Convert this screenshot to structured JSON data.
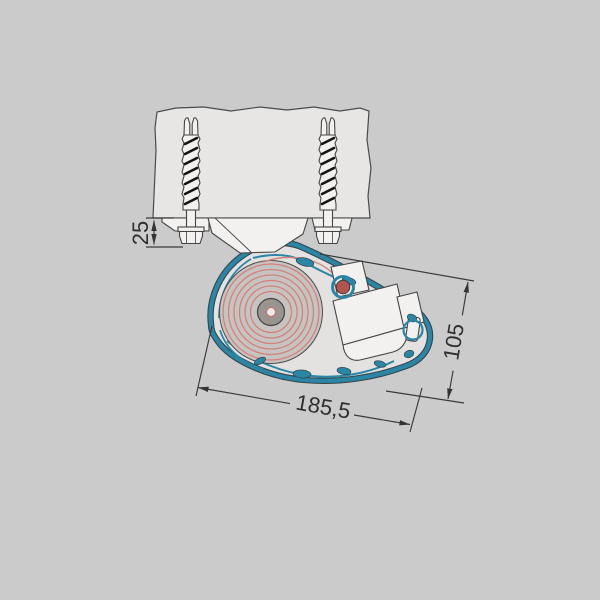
{
  "diagram": {
    "type": "technical-drawing",
    "subject": "awning-cassette-ceiling-mount-cross-section",
    "dimensions": {
      "mount_drop": "25",
      "cassette_height": "105",
      "cassette_depth": "185,5"
    },
    "colors": {
      "background": "#cbcbcb",
      "substrate": "#e7e6e4",
      "profile_teal": "#2b86a6",
      "profile_outline": "#36454c",
      "fabric_red": "#d1837b",
      "pivot_red": "#b2544b",
      "roll_gray": "#c7c3c1",
      "hub_gray": "#99948f",
      "component_white": "#f2f1ef",
      "dimension_line": "#3a3a3a"
    },
    "components": [
      {
        "name": "ceiling-substrate"
      },
      {
        "name": "wall-anchor-left"
      },
      {
        "name": "wall-anchor-right"
      },
      {
        "name": "mounting-bracket"
      },
      {
        "name": "cassette-profile"
      },
      {
        "name": "fabric-roll"
      },
      {
        "name": "motor-drive-unit"
      },
      {
        "name": "fabric-guide-pivot"
      }
    ]
  }
}
